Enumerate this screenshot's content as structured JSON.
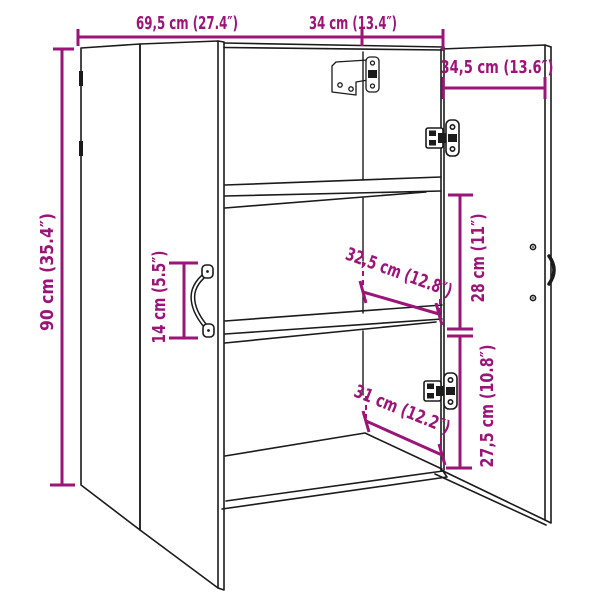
{
  "diagram": {
    "type": "furniture-dimension-drawing",
    "subject": "two-door wall cabinet, right door open showing shelves",
    "background_color": "#ffffff",
    "outline_color": "#1b1b1b",
    "dim_color": "#9a1577",
    "labels": {
      "overall_width": "69,5 cm (27.4″)",
      "depth": "34 cm (13.4″)",
      "door_width": "34,5 cm (13.6″)",
      "overall_height": "90 cm (35.4″)",
      "handle_length": "14 cm (5.5″)",
      "upper_compartment_height": "28 cm (11″)",
      "lower_compartment_height": "27,5 cm (10.8″)",
      "upper_inner_width": "32,5 cm (12.8″)",
      "lower_inner_width": "31 cm (12.2″)"
    }
  }
}
